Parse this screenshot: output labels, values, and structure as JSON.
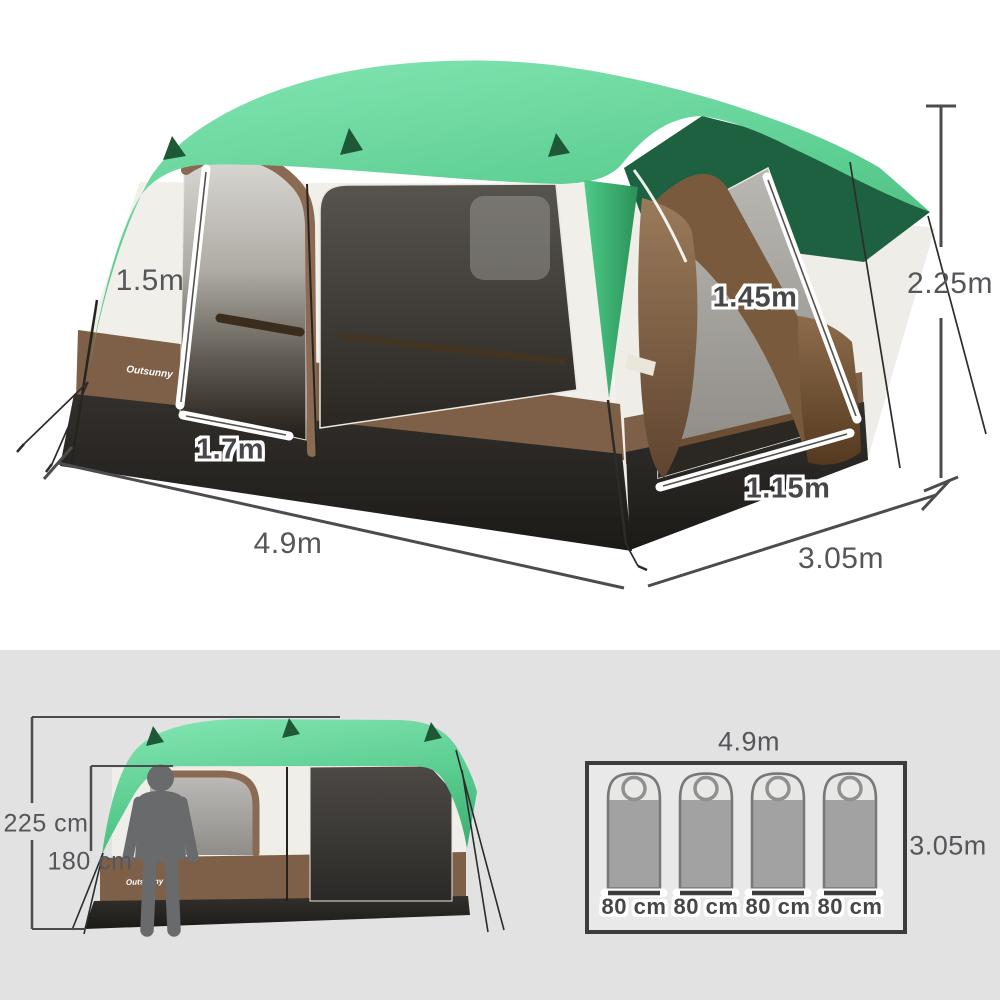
{
  "brand": {
    "logo_text": "Outsunny"
  },
  "main_view": {
    "labels": {
      "length": "4.9m",
      "depth": "3.05m",
      "height": "2.25m",
      "front_door_height": "1.5m",
      "front_door_width": "1.7m",
      "side_door_height": "1.45m",
      "side_door_width": "1.15m"
    }
  },
  "scale_view": {
    "labels": {
      "tent_height": "225 cm",
      "person_height": "180 cm"
    }
  },
  "floor_plan": {
    "labels": {
      "length": "4.9m",
      "depth": "3.05m"
    },
    "sleeping_bag_widths": [
      "80 cm",
      "80 cm",
      "80 cm",
      "80 cm"
    ]
  },
  "colors": {
    "canopy_green": "#5ecf93",
    "canopy_green_dark": "#1d6140",
    "fabric_cream": "#f1efe9",
    "trim_brown": "#7e5f47",
    "base_black": "#26241f",
    "mesh_gray": "#8f8d88",
    "dimension_text": "#55565a",
    "panel_background": "#e2e2e2"
  }
}
